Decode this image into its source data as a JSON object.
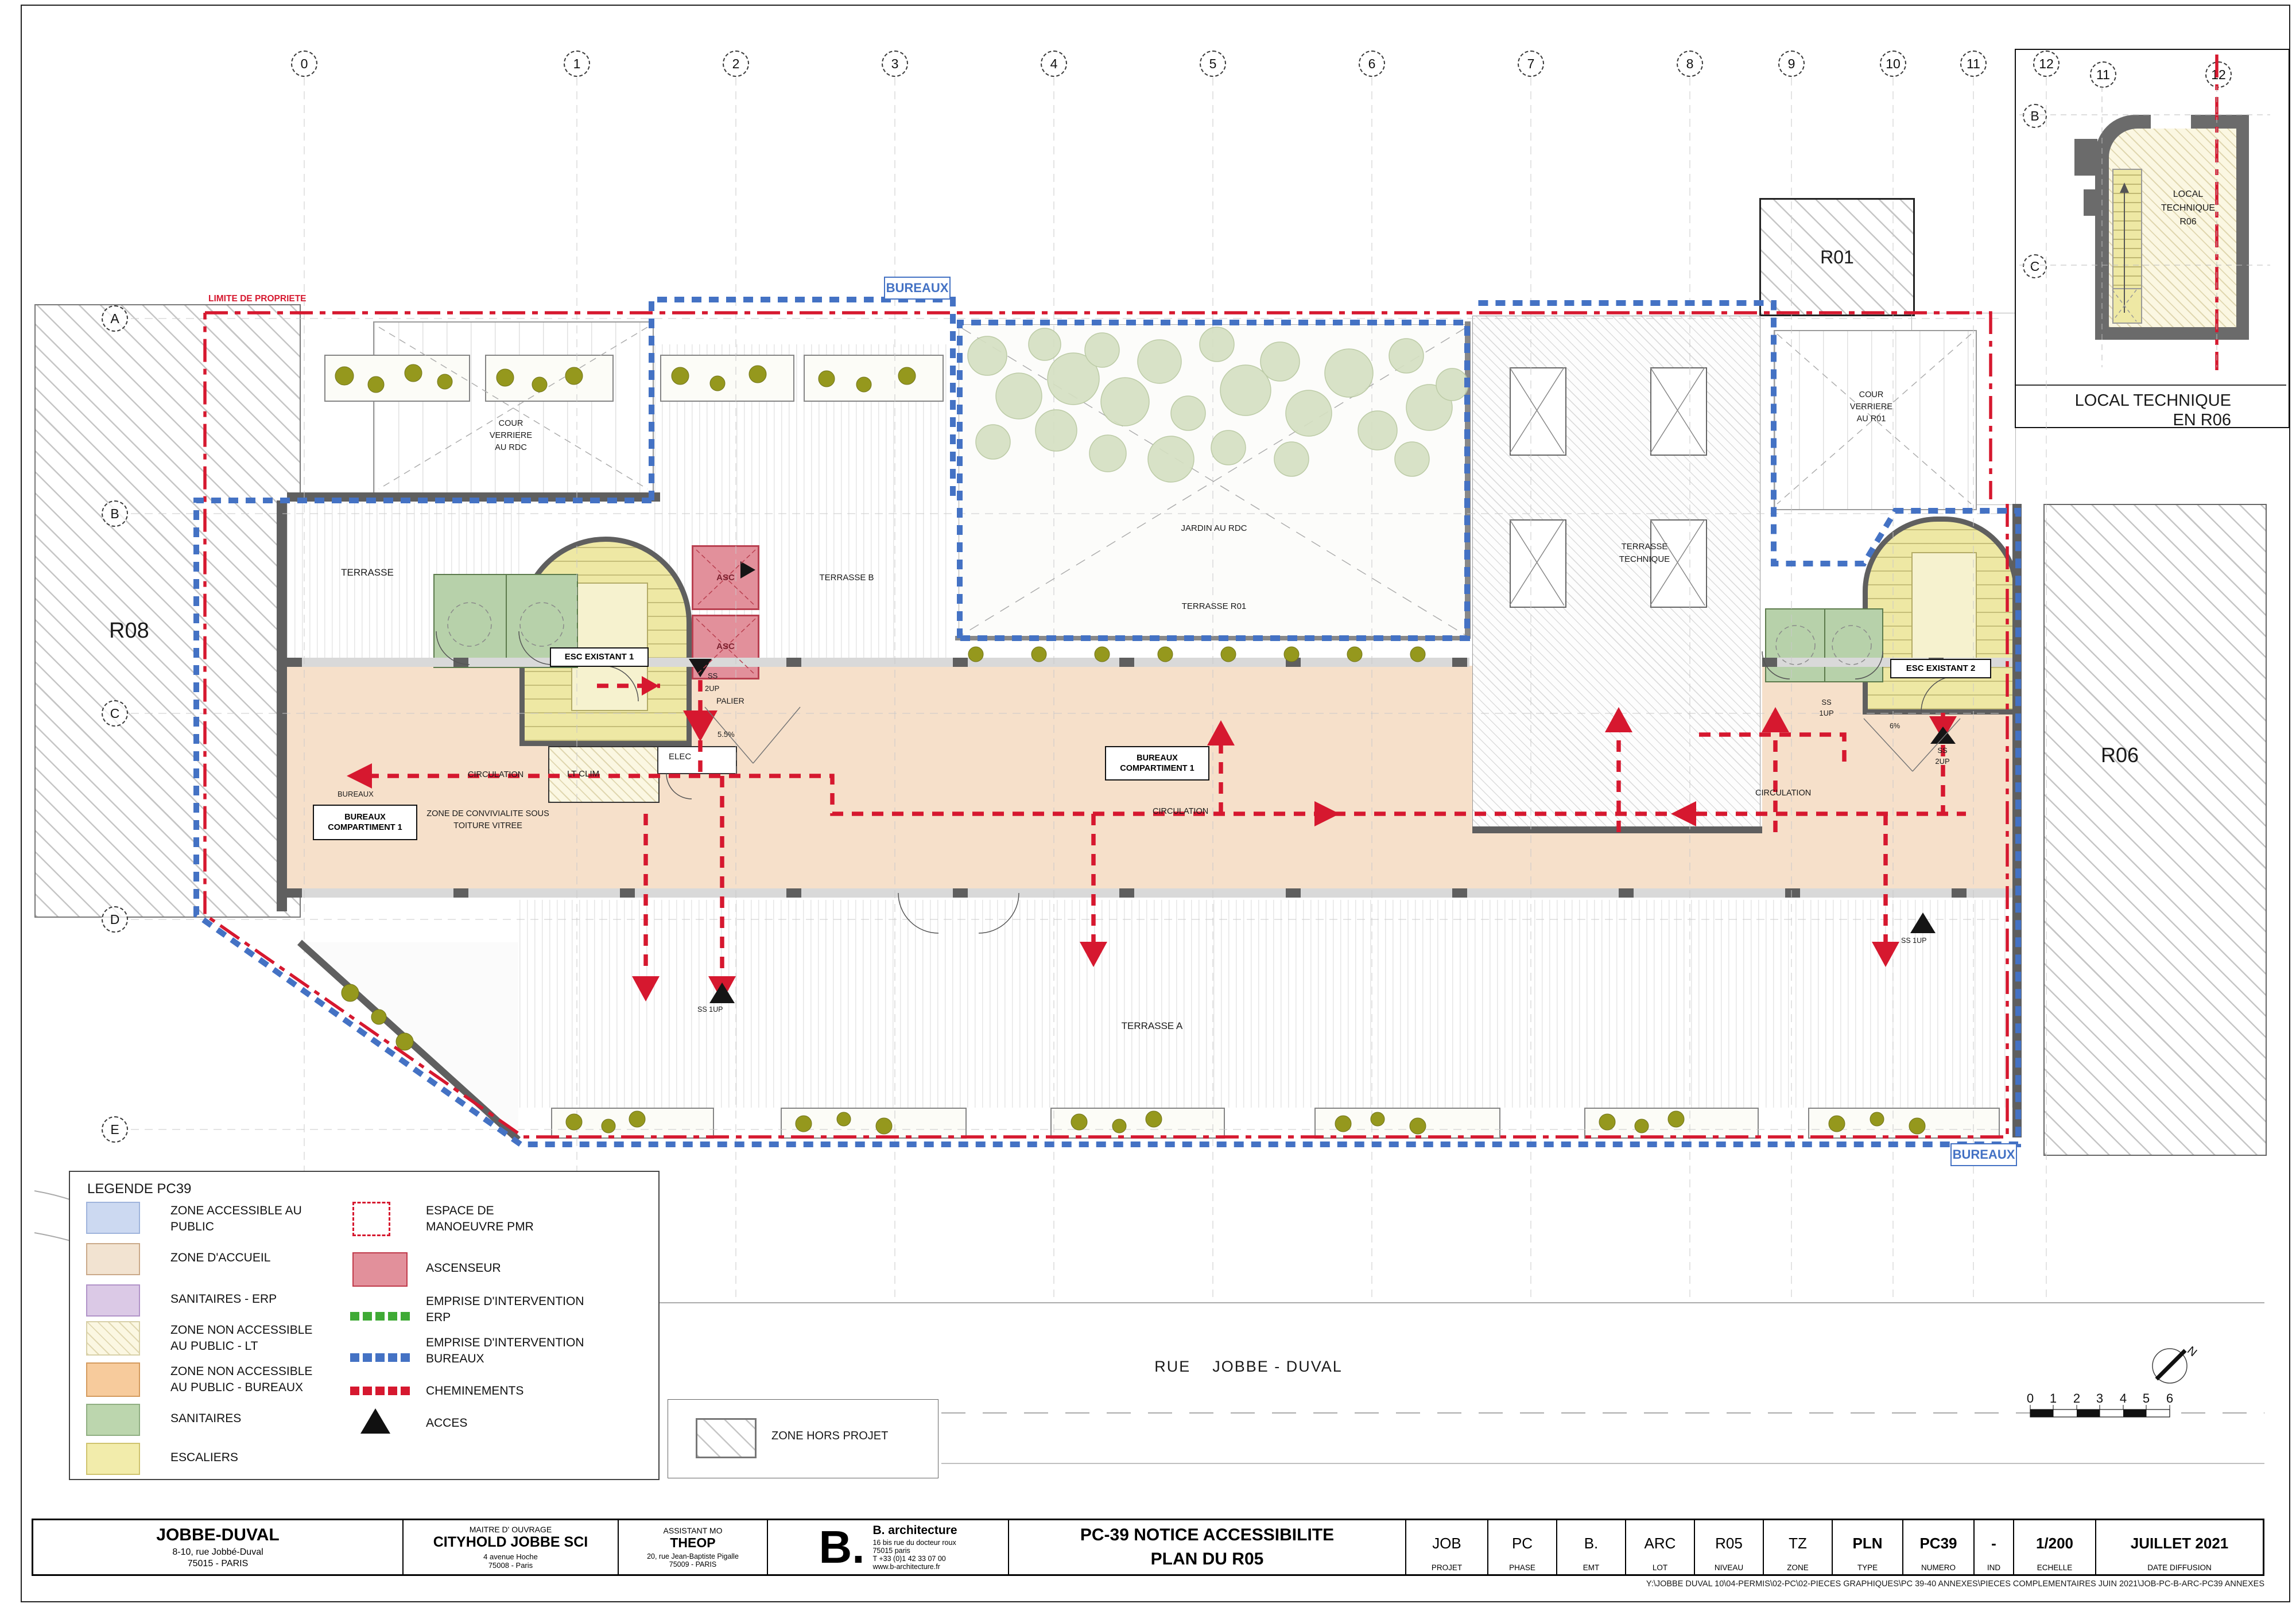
{
  "colors": {
    "accent_red": "#d6182f",
    "emprise_blue": "#4472c4",
    "erp_green": "#3faa35",
    "wall_gray": "#5f5f5f",
    "stair_yellow": "#eee8a4",
    "lift_pink": "#e2909b",
    "sanitaires_green": "#b7d1aa",
    "accueil_peach": "#f6e0ca"
  },
  "grid": {
    "cols": [
      "0",
      "1",
      "2",
      "3",
      "4",
      "5",
      "6",
      "7",
      "8",
      "9",
      "10",
      "11",
      "12"
    ],
    "rows": [
      "A",
      "B",
      "C",
      "D",
      "E"
    ]
  },
  "plan": {
    "limite": "LIMITE DE PROPRIETE",
    "r08": "R08",
    "r06": "R06",
    "r01": "R01",
    "cour_rdc": [
      "COUR",
      "VERRIERE",
      "AU RDC"
    ],
    "cour_r01": [
      "COUR",
      "VERRIERE",
      "AU R01"
    ],
    "jardin": "JARDIN AU RDC",
    "terrasse_r01": "TERRASSE R01",
    "terrasse_tech": [
      "TERRASSE",
      "TECHNIQUE"
    ],
    "terrasse_b": "TERRASSE B",
    "terrasse_a": "TERRASSE A",
    "terrasse": "TERRASSE",
    "esc1": "ESC EXISTANT 1",
    "esc2": "ESC EXISTANT 2",
    "asc": "ASC",
    "bureaux_line1": "BUREAUX",
    "bureaux_line2": "COMPARTIMENT 1",
    "bureaux_small": "BUREAUX",
    "zone_conv1": "ZONE DE CONVIVIALITE SOUS",
    "zone_conv2": "TOITURE VITREE",
    "circulation": "CIRCULATION",
    "lt_clim": "LT CLIM",
    "elec": "ELEC",
    "palier": "PALIER",
    "ss": "SS",
    "up2": "2UP",
    "up1": "1UP",
    "slope55": "5.5%",
    "slope6": "6%",
    "bureaux_tag": "BUREAUX",
    "rue1": "RUE",
    "rue2": "JOBBE - DUVAL",
    "zone_hors": "ZONE HORS PROJET",
    "north": "N",
    "scale_ticks": [
      "0",
      "1",
      "2",
      "3",
      "4",
      "5",
      "6"
    ]
  },
  "inset": {
    "cols": [
      "11",
      "12"
    ],
    "rows": [
      "B",
      "C"
    ],
    "room": [
      "LOCAL",
      "TECHNIQUE",
      "R06"
    ],
    "caption1": "LOCAL TECHNIQUE",
    "caption2": "EN R06"
  },
  "legend": {
    "title": "LEGENDE PC39",
    "left": [
      [
        "ZONE ACCESSIBLE AU",
        "PUBLIC"
      ],
      [
        "ZONE D'ACCUEIL"
      ],
      [
        "SANITAIRES - ERP"
      ],
      [
        "ZONE NON ACCESSIBLE",
        "AU PUBLIC - LT"
      ],
      [
        "ZONE NON ACCESSIBLE",
        "AU PUBLIC - BUREAUX"
      ],
      [
        "SANITAIRES"
      ],
      [
        "ESCALIERS"
      ]
    ],
    "right": [
      [
        "ESPACE DE",
        "MANOEUVRE PMR"
      ],
      [
        "ASCENSEUR"
      ],
      [
        "EMPRISE D'INTERVENTION",
        "ERP"
      ],
      [
        "EMPRISE D'INTERVENTION",
        "BUREAUX"
      ],
      [
        "CHEMINEMENTS"
      ],
      [
        "ACCES"
      ]
    ]
  },
  "titleblock": {
    "owner": {
      "name": "JOBBE-DUVAL",
      "addr1": "8-10, rue Jobbé-Duval",
      "addr2": "75015 - PARIS"
    },
    "mo": {
      "role": "MAITRE D' OUVRAGE",
      "name": "CITYHOLD JOBBE SCI",
      "addr1": "4 avenue Hoche",
      "addr2": "75008 - Paris"
    },
    "amo": {
      "role": "ASSISTANT MO",
      "name": "THEOP",
      "addr1": "20, rue Jean-Baptiste Pigalle",
      "addr2": "75009 - PARIS"
    },
    "arch": {
      "logo": "B.",
      "name": "B. architecture",
      "addr1": "16 bis rue du docteur roux",
      "addr2": "75015 paris",
      "addr3": "T +33 (0)1 42 33 07 00",
      "addr4": "www.b-architecture.fr"
    },
    "title1": "PC-39 NOTICE ACCESSIBILITE",
    "title2": "PLAN DU R05",
    "cells": [
      {
        "v": "JOB",
        "l": "PROJET"
      },
      {
        "v": "PC",
        "l": "PHASE"
      },
      {
        "v": "B.",
        "l": "EMT"
      },
      {
        "v": "ARC",
        "l": "LOT"
      },
      {
        "v": "R05",
        "l": "NIVEAU"
      },
      {
        "v": "TZ",
        "l": "ZONE"
      },
      {
        "v": "PLN",
        "l": "TYPE"
      },
      {
        "v": "PC39",
        "l": "NUMERO"
      },
      {
        "v": "-",
        "l": "IND"
      },
      {
        "v": "1/200",
        "l": "ECHELLE"
      },
      {
        "v": "JUILLET 2021",
        "l": "DATE DIFFUSION"
      }
    ],
    "path": "Y:\\JOBBE DUVAL 10\\04-PERMIS\\02-PC\\02-PIECES GRAPHIQUES\\PC 39-40 ANNEXES\\PIECES COMPLEMENTAIRES JUIN 2021\\JOB-PC-B-ARC-PC39 ANNEXES"
  }
}
